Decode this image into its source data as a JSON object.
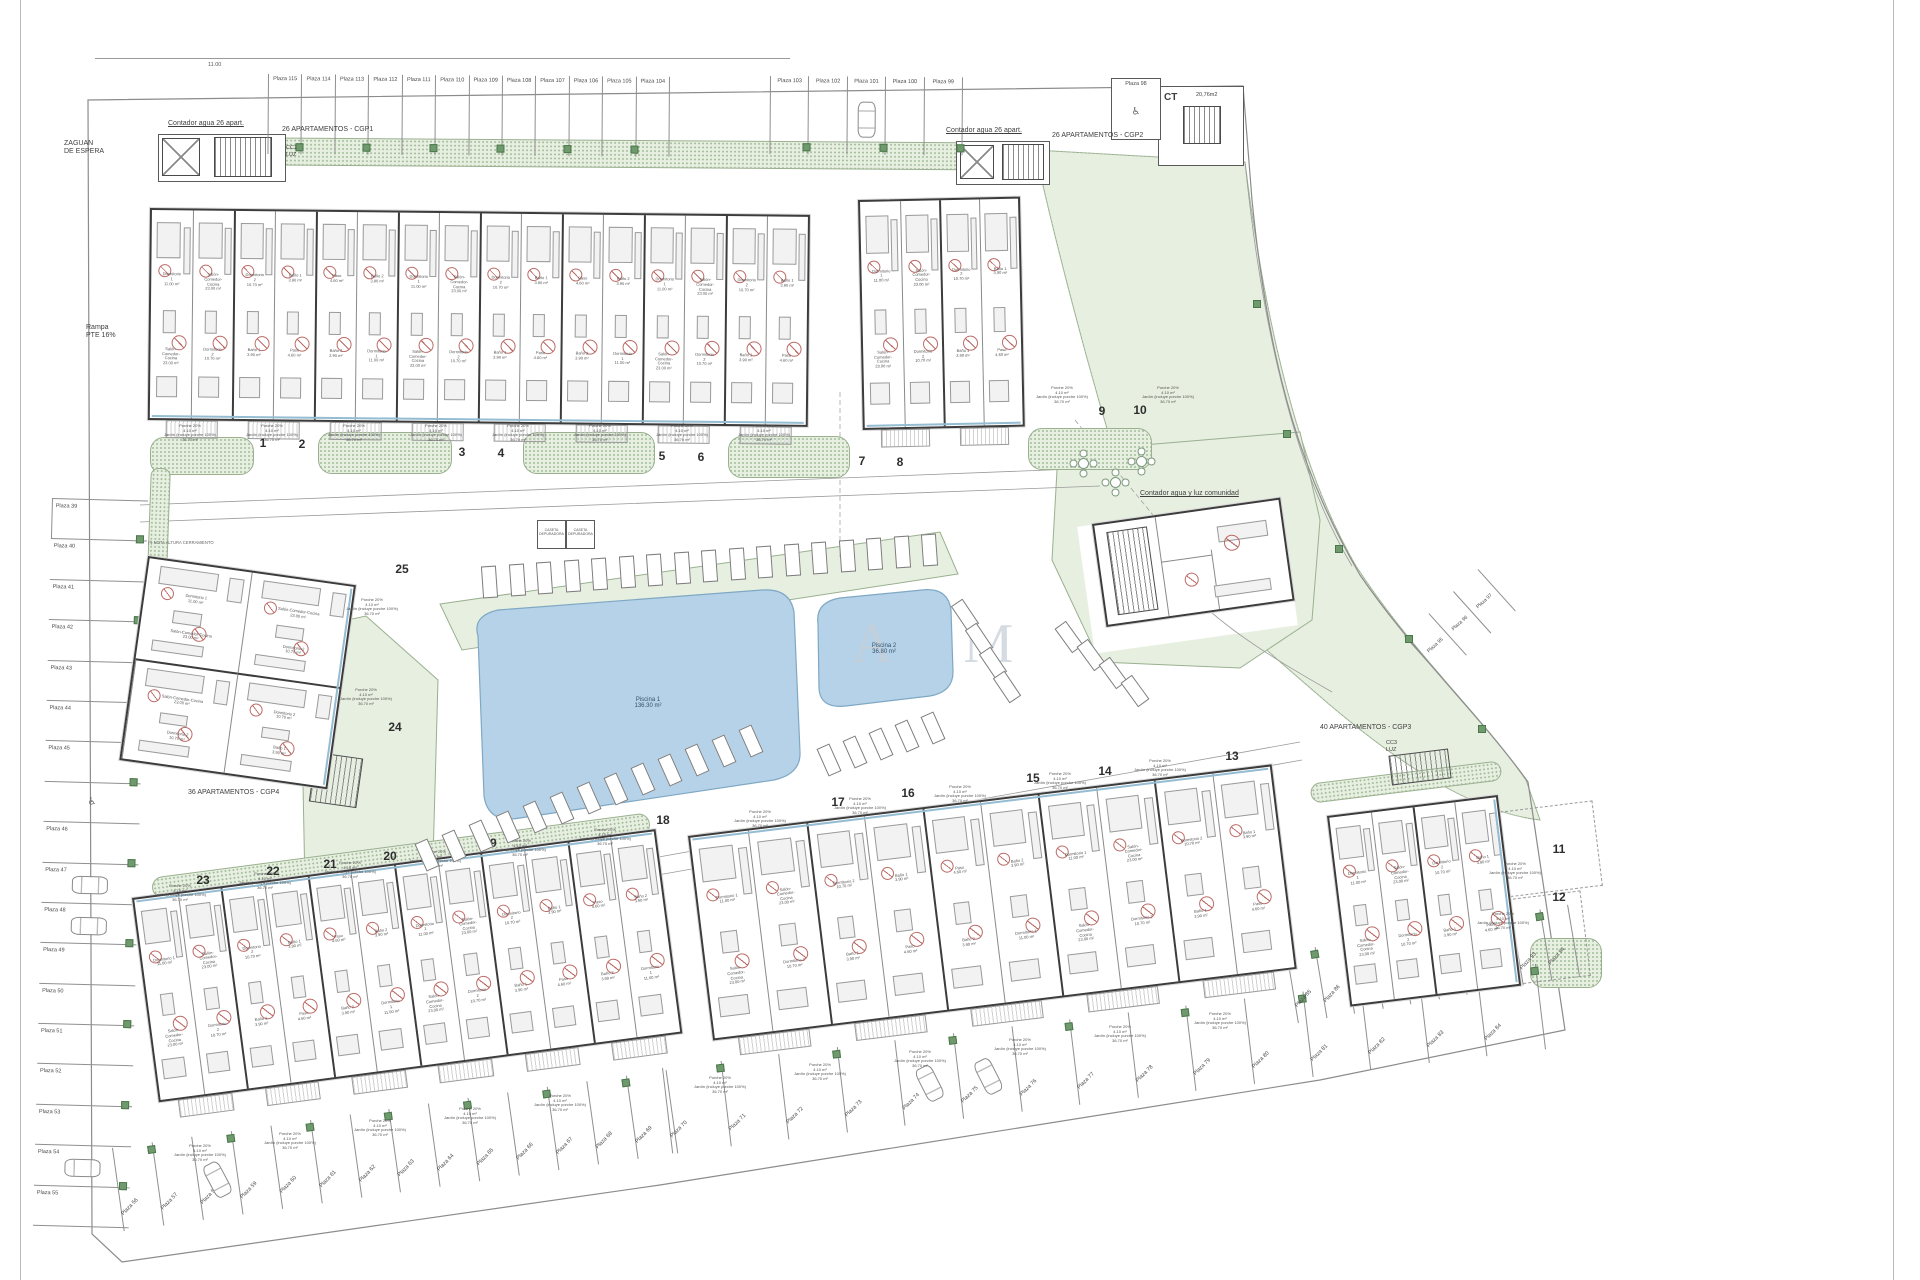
{
  "page": {
    "watermark": "A M"
  },
  "annotations": {
    "zaguan": "ZAGUAN\nDE ESPERA",
    "rampa": "Rampa\nPTE 16%",
    "contador_26_left": "Contador agua 26 apart.",
    "contador_26_mid": "Contador agua 26 apart.",
    "contador_comunidad": "Contador agua y luz comunidad",
    "cgp1": "26 APARTAMENTOS - CGP1",
    "cgp2": "26 APARTAMENTOS - CGP2",
    "cgp3": "40 APARTAMENTOS - CGP3",
    "cgp4": "36 APARTAMENTOS - CGP4",
    "cc1": "CC1\nLUZ",
    "cc3": "CC3\nLUZ",
    "ct_name": "CT",
    "ct_area": "20,76m2",
    "nota": "(*) NOTA ALTURA CERRAMIENTO",
    "caseta": "CASETA\nDEPURADORA",
    "dim_top": "11.00",
    "handicap_symbol": "♿"
  },
  "pools": [
    {
      "name": "Piscina 1",
      "area": "136.30 m²"
    },
    {
      "name": "Piscina 2",
      "area": "36.80 m²"
    }
  ],
  "unit_numbers": [
    "1",
    "2",
    "3",
    "4",
    "5",
    "6",
    "7",
    "8",
    "9",
    "10",
    "11",
    "12",
    "13",
    "14",
    "15",
    "16",
    "17",
    "18",
    "19",
    "20",
    "21",
    "22",
    "23",
    "24",
    "25"
  ],
  "rooms": [
    "Dormitorio 1\n11.00 m²",
    "Salón-Comedor-Cocina\n23.00 m²",
    "Dormitorio 2\n10.70 m²",
    "Baño 1\n3.90 m²",
    "Paso\n4.60 m²",
    "Baño 2\n3.90 m²"
  ],
  "garden_labels": {
    "porche": "Porche 20%\n4.10 m²",
    "jardin": "Jardín (incluye porche 100%)\n36.70 m²"
  },
  "parking": {
    "top_a": [
      "Plaza 115",
      "Plaza 114",
      "Plaza 113",
      "Plaza 112",
      "Plaza 111",
      "Plaza 110",
      "Plaza 109",
      "Plaza 108",
      "Plaza 107",
      "Plaza 106",
      "Plaza 105",
      "Plaza 104"
    ],
    "top_b": [
      "Plaza 103",
      "Plaza 102",
      "Plaza 101",
      "Plaza 100",
      "Plaza 99"
    ],
    "isolated": "Plaza 98",
    "left": [
      "Plaza 39",
      "Plaza 40",
      "Plaza 41",
      "Plaza 42",
      "Plaza 43",
      "Plaza 44",
      "Plaza 45",
      "♿",
      "Plaza 46",
      "Plaza 47",
      "Plaza 48",
      "Plaza 49",
      "Plaza 50",
      "Plaza 51",
      "Plaza 52",
      "Plaza 53",
      "Plaza 54",
      "Plaza 55"
    ],
    "bottom_a": [
      "Plaza 56",
      "Plaza 57",
      "Plaza 58",
      "Plaza 59",
      "Plaza 60",
      "Plaza 61",
      "Plaza 62",
      "Plaza 63",
      "Plaza 64",
      "Plaza 65",
      "Plaza 66",
      "Plaza 67",
      "Plaza 68",
      "Plaza 69"
    ],
    "bottom_b": [
      "Plaza 70",
      "Plaza 71",
      "Plaza 72",
      "Plaza 73",
      "Plaza 74",
      "Plaza 75",
      "Plaza 76",
      "Plaza 77",
      "Plaza 78",
      "Plaza 79",
      "Plaza 80",
      "Plaza 81",
      "Plaza 82",
      "Plaza 83",
      "Plaza 84"
    ],
    "right_b": [
      "Plaza 85",
      "Plaza 86",
      "Plaza 87",
      "Plaza 88",
      "Plaza 89",
      "Plaza 90",
      "Plaza 91",
      "Plaza 92",
      "Plaza 93",
      "Plaza 94"
    ],
    "diag": [
      "Plaza 95",
      "Plaza 96",
      "Plaza 97"
    ]
  }
}
